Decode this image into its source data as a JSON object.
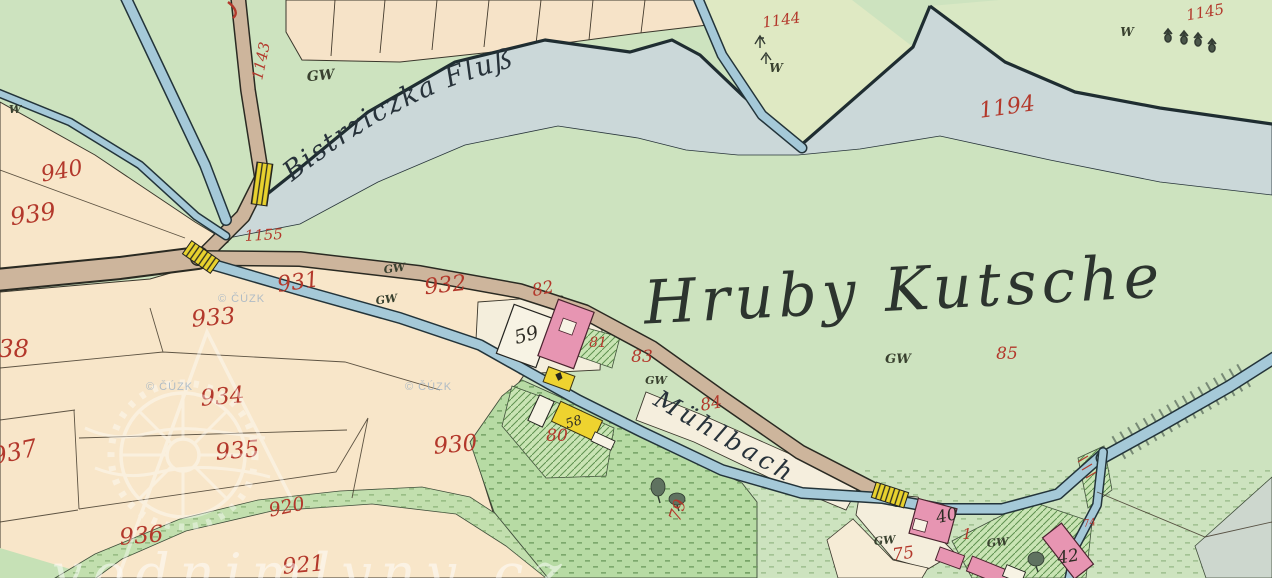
{
  "map": {
    "region_title": "Hruby Kutsche",
    "watercourses": {
      "river": "Bistrziczka Fluß",
      "millstream": "Mühlbach"
    },
    "watermark": {
      "copyright": "© ČÚZK",
      "site": "vodnimlyny cz"
    },
    "colors": {
      "water": "#cbd8d9",
      "stream": "#a5c9d8",
      "meadow": "#cde3bf",
      "field_cream": "#f8e6c9",
      "road": "#cdb59c",
      "building_masonry": "#e795b2",
      "building_wood": "#eed32f",
      "bridge": "#e8d22e",
      "parcel_number_red": "#b3382b",
      "ink": "#2e2c24"
    },
    "parcel_numbers": [
      "940",
      "939",
      "938",
      "937",
      "936",
      "935",
      "934",
      "933",
      "932",
      "931",
      "930",
      "921",
      "920",
      "1143",
      "1144",
      "1145",
      "1155",
      "1194",
      "79",
      "80",
      "81",
      "82",
      "83",
      "84",
      "85",
      "75",
      "74",
      "1"
    ],
    "house_numbers": [
      "59",
      "58",
      "40",
      "42"
    ],
    "landuse_marks": [
      "GW",
      "W"
    ]
  },
  "labels": [
    {
      "t": "940",
      "x": 63,
      "y": 178,
      "r": -10,
      "s": 22,
      "c": "red"
    },
    {
      "t": "939",
      "x": 34,
      "y": 222,
      "r": -8,
      "s": 24,
      "c": "red"
    },
    {
      "t": "938",
      "x": 6,
      "y": 357,
      "r": 0,
      "s": 24,
      "c": "red"
    },
    {
      "t": "937",
      "x": 16,
      "y": 460,
      "r": -12,
      "s": 24,
      "c": "red"
    },
    {
      "t": "933",
      "x": 214,
      "y": 325,
      "r": -5,
      "s": 23,
      "c": "red"
    },
    {
      "t": "934",
      "x": 223,
      "y": 404,
      "r": -5,
      "s": 23,
      "c": "red"
    },
    {
      "t": "935",
      "x": 238,
      "y": 458,
      "r": -5,
      "s": 23,
      "c": "red"
    },
    {
      "t": "936",
      "x": 142,
      "y": 543,
      "r": -5,
      "s": 23,
      "c": "red"
    },
    {
      "t": "930",
      "x": 456,
      "y": 452,
      "r": -5,
      "s": 23,
      "c": "red"
    },
    {
      "t": "931",
      "x": 299,
      "y": 289,
      "r": -8,
      "s": 22,
      "c": "red"
    },
    {
      "t": "932",
      "x": 446,
      "y": 292,
      "r": -6,
      "s": 22,
      "c": "red"
    },
    {
      "t": "920",
      "x": 288,
      "y": 513,
      "r": -12,
      "s": 19,
      "c": "red"
    },
    {
      "t": "921",
      "x": 304,
      "y": 572,
      "r": -5,
      "s": 22,
      "c": "red"
    },
    {
      "t": "1155",
      "x": 264,
      "y": 240,
      "r": -3,
      "s": 15,
      "c": "red"
    },
    {
      "t": "1143",
      "x": 266,
      "y": 62,
      "r": -78,
      "s": 15,
      "c": "red"
    },
    {
      "t": "1144",
      "x": 782,
      "y": 25,
      "r": -8,
      "s": 15,
      "c": "red"
    },
    {
      "t": "1145",
      "x": 1206,
      "y": 17,
      "r": -10,
      "s": 15,
      "c": "red"
    },
    {
      "t": "1194",
      "x": 1008,
      "y": 114,
      "r": -8,
      "s": 22,
      "c": "red"
    },
    {
      "t": "82",
      "x": 544,
      "y": 294,
      "r": -12,
      "s": 17,
      "c": "red"
    },
    {
      "t": "83",
      "x": 642,
      "y": 362,
      "r": 0,
      "s": 17,
      "c": "red"
    },
    {
      "t": "84",
      "x": 712,
      "y": 409,
      "r": -10,
      "s": 17,
      "c": "red"
    },
    {
      "t": "85",
      "x": 1007,
      "y": 359,
      "r": 0,
      "s": 17,
      "c": "red"
    },
    {
      "t": "81",
      "x": 598,
      "y": 347,
      "r": 0,
      "s": 14,
      "c": "red"
    },
    {
      "t": "80",
      "x": 557,
      "y": 441,
      "r": 0,
      "s": 17,
      "c": "red"
    },
    {
      "t": "79",
      "x": 683,
      "y": 512,
      "r": -72,
      "s": 17,
      "c": "red"
    },
    {
      "t": "75",
      "x": 904,
      "y": 559,
      "r": -8,
      "s": 17,
      "c": "red"
    },
    {
      "t": "1",
      "x": 967,
      "y": 539,
      "r": 0,
      "s": 15,
      "c": "red"
    },
    {
      "t": "74",
      "x": 1090,
      "y": 526,
      "r": -10,
      "s": 10,
      "c": "red"
    },
    {
      "t": "59",
      "x": 528,
      "y": 341,
      "r": -15,
      "s": 19,
      "c": "blk"
    },
    {
      "t": "58",
      "x": 575,
      "y": 426,
      "r": -18,
      "s": 13,
      "c": "blk"
    },
    {
      "t": "40",
      "x": 948,
      "y": 521,
      "r": -12,
      "s": 17,
      "c": "blk"
    },
    {
      "t": "42",
      "x": 1069,
      "y": 562,
      "r": -10,
      "s": 17,
      "c": "blk"
    },
    {
      "t": "GW",
      "x": 321,
      "y": 80,
      "r": -5,
      "s": 14,
      "c": "gw"
    },
    {
      "t": "GW",
      "x": 395,
      "y": 272,
      "r": -8,
      "s": 11,
      "c": "gw"
    },
    {
      "t": "GW",
      "x": 387,
      "y": 303,
      "r": -8,
      "s": 11,
      "c": "gw"
    },
    {
      "t": "GW",
      "x": 656,
      "y": 384,
      "r": 0,
      "s": 11,
      "c": "gw"
    },
    {
      "t": "GW",
      "x": 898,
      "y": 363,
      "r": 0,
      "s": 13,
      "c": "gw"
    },
    {
      "t": "GW",
      "x": 885,
      "y": 544,
      "r": -5,
      "s": 11,
      "c": "gw"
    },
    {
      "t": "GW",
      "x": 998,
      "y": 546,
      "r": -5,
      "s": 11,
      "c": "gw"
    },
    {
      "t": "W",
      "x": 776,
      "y": 72,
      "r": 0,
      "s": 12,
      "c": "gw"
    },
    {
      "t": "W",
      "x": 1127,
      "y": 36,
      "r": 0,
      "s": 12,
      "c": "gw"
    },
    {
      "t": "W",
      "x": 15,
      "y": 113,
      "r": 0,
      "s": 11,
      "c": "gw"
    }
  ]
}
